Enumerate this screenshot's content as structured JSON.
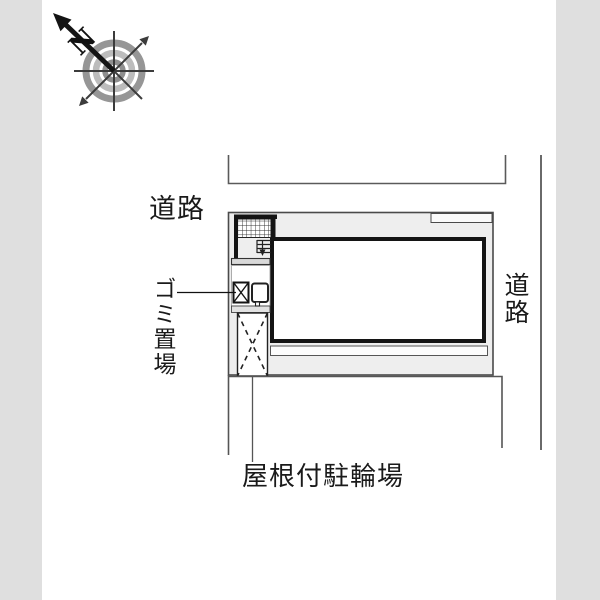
{
  "drawing": {
    "kind": "site-plan",
    "compass": {
      "north_label": "N"
    },
    "labels": {
      "road_top": "道路",
      "road_right": "道路",
      "garbage_area": "ゴミ置場",
      "covered_bicycle_parking": "屋根付駐輪場"
    },
    "colors": {
      "background": "#ffffff",
      "road_margin_band": "#dfdfdf",
      "footprint_fill": "#eeeeee",
      "boundary_line": "#555555",
      "room_border": "#141414",
      "compass_ring_outer": "#969696",
      "compass_ring_mid": "#bcbcbc",
      "compass_ring_inner": "#8f8f8f"
    }
  }
}
